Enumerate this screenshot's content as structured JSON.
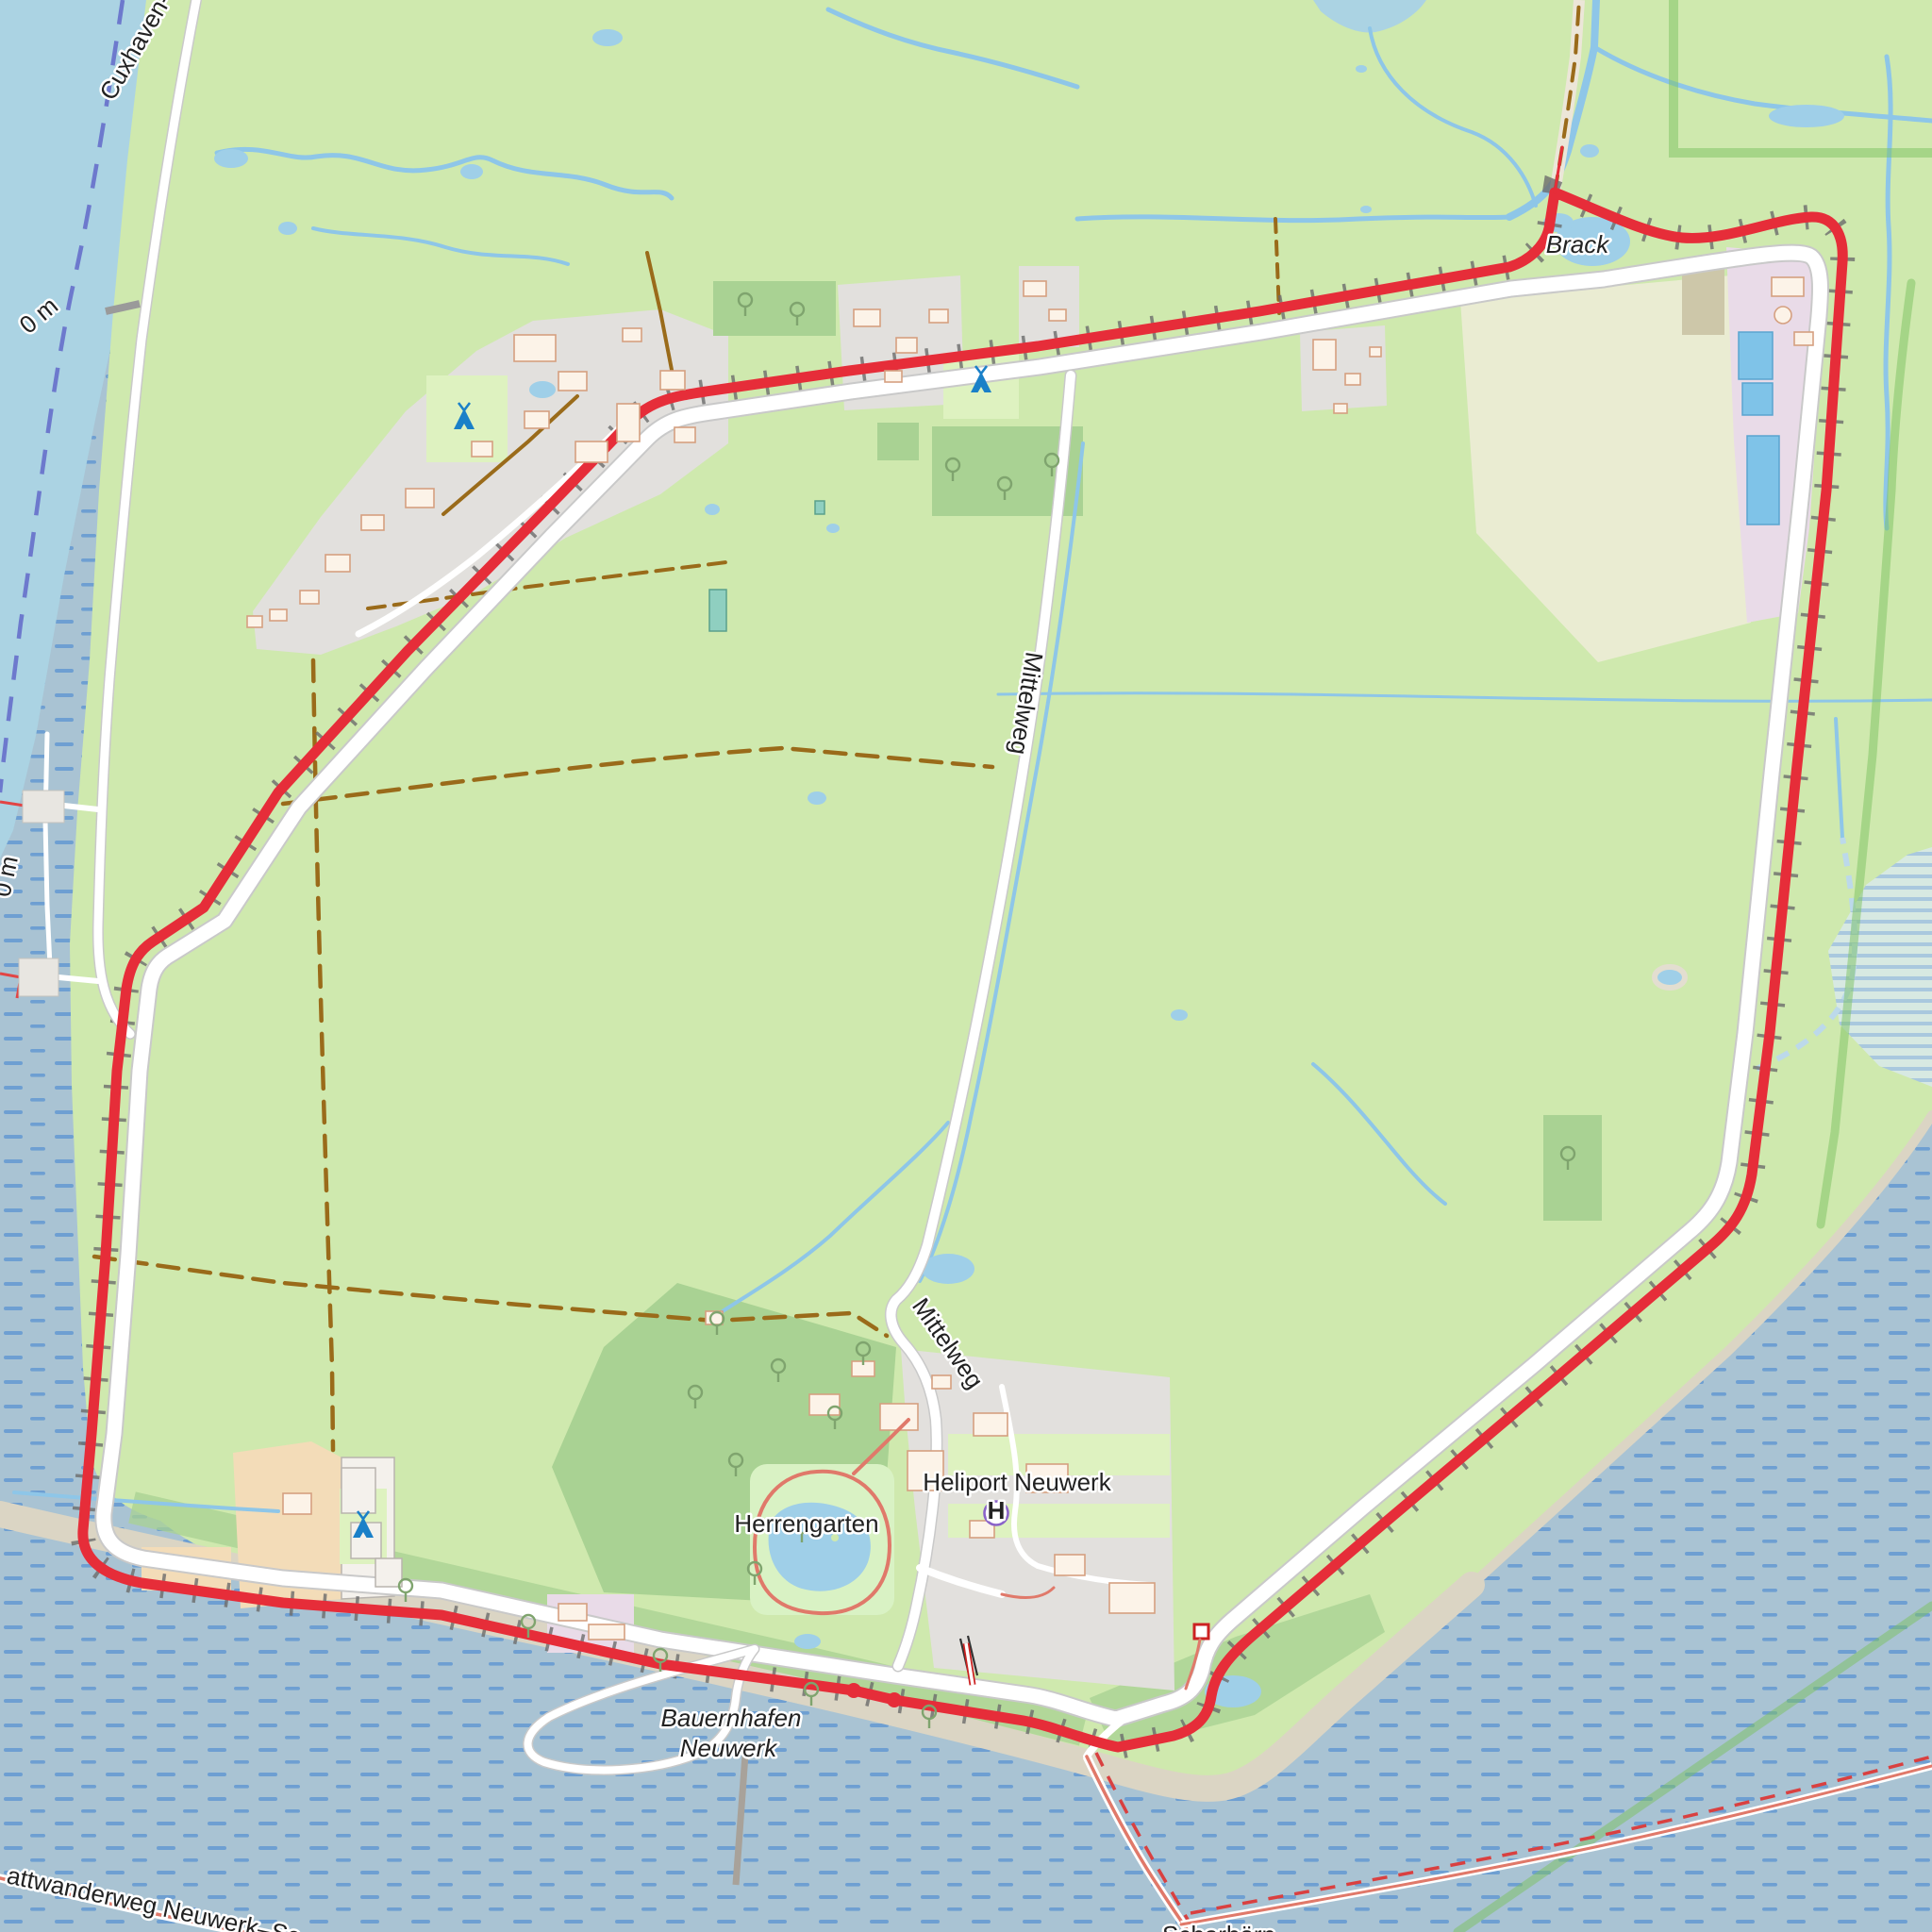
{
  "app": {
    "type": "map",
    "description": "Topographic web-map view of the island of Neuwerk (Wadden Sea) with a red GPS track following the dike around the island"
  },
  "colors": {
    "sea": "#a9c3d3",
    "sea_dash": "#5690d2",
    "channel": "#abd3e3",
    "land": "#cfe9ae",
    "wood": "#a9d293",
    "campsite_green": "#def2c0",
    "farmland": "#eaecd2",
    "farmyard": "#f3dcb8",
    "residential": "#e2e0dd",
    "industrial": "#e9dbe8",
    "water_fill": "#9fcfe8",
    "basin": "#7fc3e8",
    "sand": "#dbd5c4",
    "road": "#ffffff",
    "road_casing": "#c9c9c9",
    "track": "#9a6b1a",
    "dike": "#6c6c6c",
    "route": "#e62d39",
    "stream": "#8ec6e8",
    "boundary": "#7cc160",
    "ferry": "#6168c9",
    "garden_path": "#e0796a",
    "tent": "#1a80c8",
    "heliport_label": "#8a63c9",
    "water_label": "#33618e",
    "ferry_label": "#5a63c0",
    "depth_label": "#8e9aa8",
    "text": "#222222",
    "building": "#fcf3e8",
    "building_stroke": "#d5a080"
  },
  "labels": {
    "waterway": {
      "text": "Cuxhaven-"
    },
    "depth_markers": [
      "0 m",
      "0 m"
    ],
    "pond": {
      "text": "Brack"
    },
    "road_north": {
      "text": "Mittelweg"
    },
    "road_south": {
      "text": "Mittelweg"
    },
    "heliport": {
      "text": "Heliport Neuwerk",
      "symbol": "H"
    },
    "garden": {
      "text": "Herrengarten"
    },
    "harbor": {
      "line1": "Bauernhafen",
      "line2": "Neuwerk"
    },
    "trail_sw": {
      "text": "attwanderweg Neuwerk–Sc"
    },
    "trail_se": {
      "text": "Scharhörn"
    }
  },
  "icons": {
    "campsite_count": 3,
    "campsite_icon": "tent",
    "heliport_icon": "circled-H",
    "beacon_icon": "red-square-beacon",
    "tree_icon": "deciduous-tree"
  }
}
